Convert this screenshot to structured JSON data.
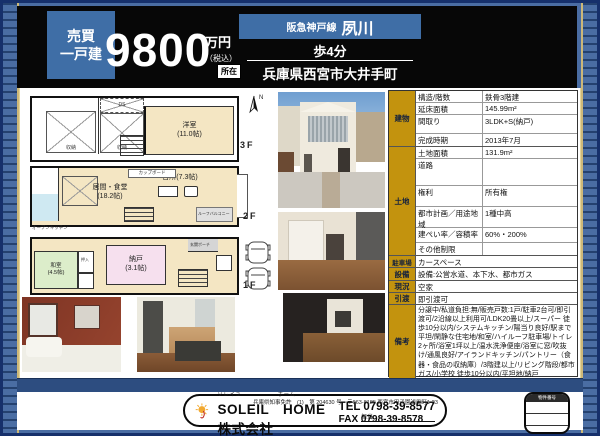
{
  "header": {
    "category_line1": "売買",
    "category_line2": "一戸建",
    "price": "9800",
    "price_unit": "万円",
    "price_tax": "（税込）",
    "location_label": "所在",
    "rail_line": "阪急神戸線",
    "station": "夙川",
    "walk": "歩4分",
    "address": "兵庫県西宮市大井手町"
  },
  "floorplans": {
    "f3_label": "3F",
    "f2_label": "2F",
    "f1_label": "1F",
    "compass_n": "N",
    "f3": {
      "yoshitsu": "洋室",
      "yoshitsu_size": "(11.0帖)",
      "closet1": "収納",
      "closet2": "収納",
      "ds": "DS"
    },
    "f2": {
      "living": "居間・食堂",
      "living_size": "(18.2帖)",
      "kitchen": "台所(7.3帖)",
      "cupboard": "カップボード",
      "open_kitchen": "オープンキッチン",
      "roof_balcony": "ルーフバルコニー"
    },
    "f1": {
      "washitsu": "和室",
      "washitsu_size": "(4.5帖)",
      "oshiire": "押入",
      "nando": "納戸",
      "nando_size": "(3.1帖)",
      "porch": "玄関ポーチ"
    }
  },
  "details": {
    "sec_build": "建物",
    "sec_land": "土地",
    "rows_build": [
      {
        "k": "構造/階数",
        "v": "鉄骨3階建"
      },
      {
        "k": "延床面積",
        "v": "145.99m²"
      },
      {
        "k": "間取り",
        "v": "3LDK+S(納戸)"
      },
      {
        "k": "完成時期",
        "v": "2013年7月"
      }
    ],
    "rows_land": [
      {
        "k": "土地面積",
        "v": "131.9m²"
      },
      {
        "k": "道路",
        "v": ""
      },
      {
        "k": "権利",
        "v": "所有権"
      },
      {
        "k": "都市計画／用途地域",
        "v": "1種中高"
      },
      {
        "k": "建ぺい率／容積率",
        "v": "60%・200%"
      },
      {
        "k": "その他制限",
        "v": ""
      }
    ],
    "full": [
      {
        "k": "駐車場",
        "v": "カースペース"
      },
      {
        "k": "設備",
        "v": "設備:公営水道、本下水、都市ガス"
      },
      {
        "k": "現況",
        "v": "空家"
      },
      {
        "k": "引渡",
        "v": "即引渡可"
      },
      {
        "k": "備考",
        "v": "分譲中/私道負担:無/販売戸数:1戸/駐車2台可/即引渡可/2沿線以上利用可/LDK20畳以上/スーパー 徒歩10分以内/システムキッチン/陽当り良好/駅まで平坦/閑静な住宅地/和室/ハイルーフ駐車場/トイレ2ヶ所/浴室1坪以上/温水洗浄便座/浴室に窓/吹抜け/通風良好/アイランドキッチン/パントリー（食器・食品の収納庫）/3階建以上/リビング階段/都市ガス/小学校 徒歩10分以内/平坦地/納戸"
      }
    ]
  },
  "footer": {
    "license": "兵庫県知事免許　(1)　第 204630 号　〒663-8185 西宮市甲子園浦風町1-23",
    "furigana1": "ソレイユ",
    "furigana2": "ホーム",
    "company": "SOLEIL　HOME株式会社",
    "tel": "TEL 0798-39-8577",
    "fax": "FAX 0798-39-8578",
    "staff_label": "担当",
    "property_box_label": "物件番号"
  },
  "colors": {
    "page_blue": "#4a6da3",
    "header_black": "#070707",
    "accent_blue_box": "#3f6ea6",
    "table_gold": "#c3930e",
    "plan_beige": "#f4e6c3",
    "navy_bar": "#2d4d80"
  }
}
